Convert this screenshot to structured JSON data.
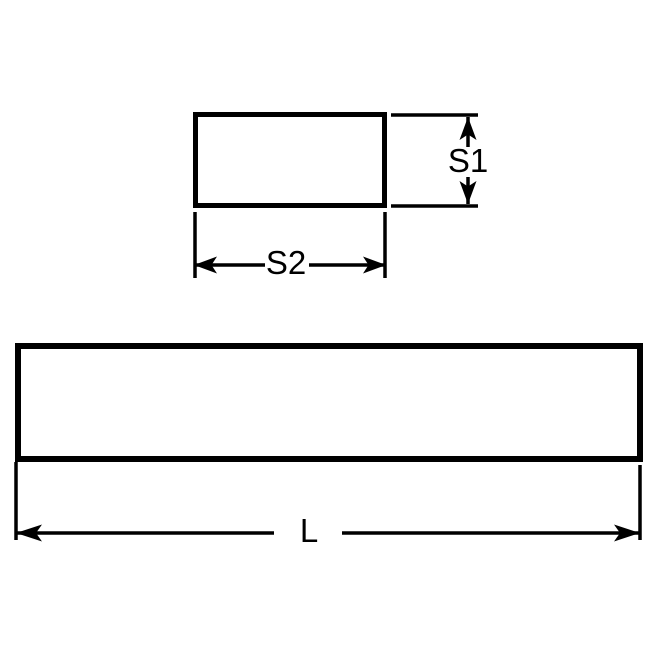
{
  "page": {
    "background_color": "#ffffff"
  },
  "drawing": {
    "line_color": "#000000",
    "label_color": "#000000",
    "views": {
      "cross_section": {
        "height_label": "S1",
        "width_label": "S2"
      },
      "side_view": {
        "length_label": "L"
      }
    }
  }
}
